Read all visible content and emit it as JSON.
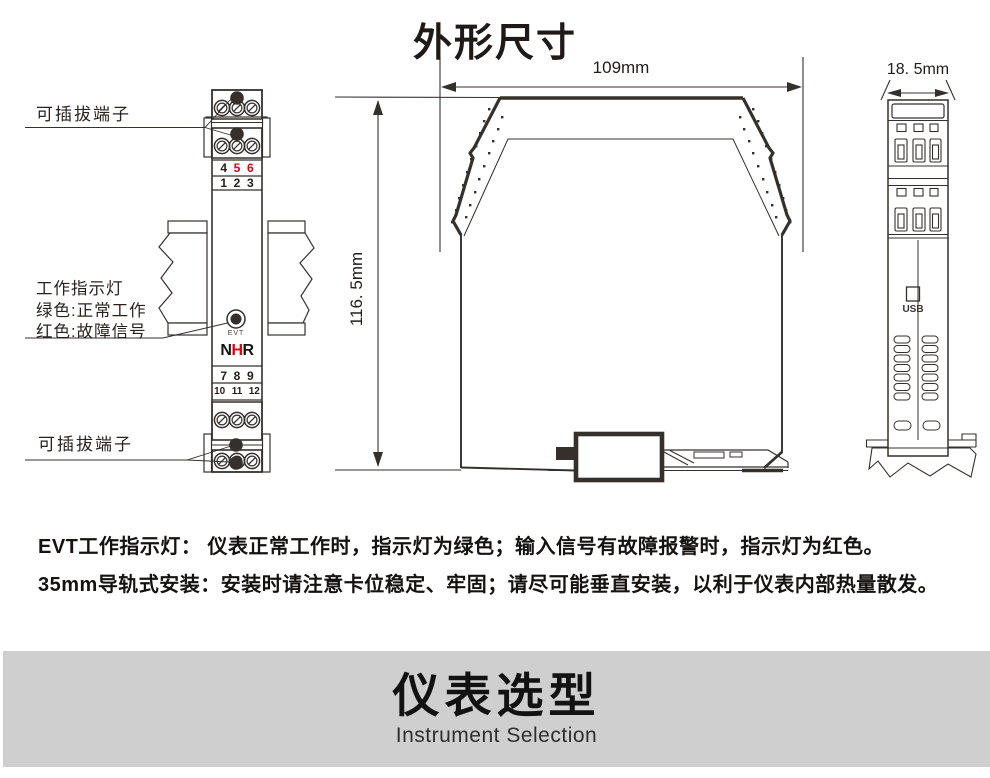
{
  "page": {
    "title": "外形尺寸"
  },
  "dimensions": {
    "width_top": "109mm",
    "height_left": "116. 5mm",
    "depth_side": "18. 5mm"
  },
  "front_view": {
    "label_top_terminal": "可插拔端子",
    "label_bottom_terminal": "可插拔端子",
    "indicator": {
      "line1": "工作指示灯",
      "line2": "绿色:正常工作",
      "line3": "红色:故障信号"
    },
    "terminal_numbers": {
      "row1": [
        "4",
        "5",
        "6"
      ],
      "row2": [
        "1",
        "2",
        "3"
      ],
      "row3": [
        "7",
        "8",
        "9"
      ],
      "row4": [
        "10",
        "11",
        "12"
      ]
    },
    "led_label": "EVT",
    "logo": {
      "n": "N",
      "h": "H",
      "r": "R"
    }
  },
  "end_view": {
    "usb_label": "USB"
  },
  "notes": {
    "line1": "EVT工作指示灯： 仪表正常工作时，指示灯为绿色；输入信号有故障报警时，指示灯为红色。",
    "line2": "35mm导轨式安装：安装时请注意卡位稳定、牢固；请尽可能垂直安装，以利于仪表内部热量散发。"
  },
  "banner": {
    "title": "仪表选型",
    "subtitle": "Instrument Selection"
  },
  "colors": {
    "accent_red": "#e60012",
    "line_ink": "#35302c",
    "banner_bg": "#d0cfd0"
  }
}
